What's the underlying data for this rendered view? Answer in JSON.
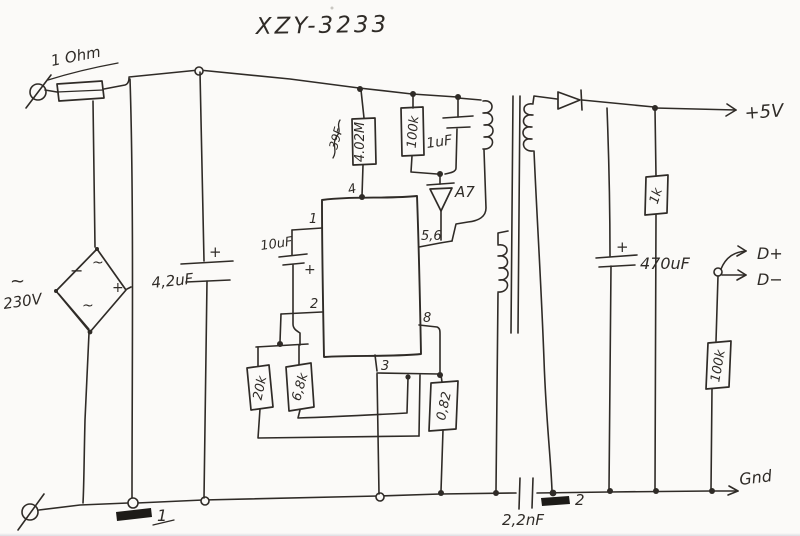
{
  "title": "XZY-3233",
  "colors": {
    "ink": "#2f2b27",
    "paper": "#fbfaf8"
  },
  "mains": {
    "fuse": "1 Ohm",
    "ac_wave": "~",
    "voltage": "230V"
  },
  "bridge": {
    "ac_top": "~",
    "minus": "−",
    "ac_bottom": "~",
    "plus": "+"
  },
  "primary_side": {
    "bulk_cap": "4,2uF",
    "bulk_cap_plus": "+",
    "startup_r": "4.02M",
    "startup_note": "39F",
    "r100k": "100k",
    "c1uf": "1uF",
    "zener": "A7",
    "c10uf": "10uF",
    "c10uf_plus": "+",
    "r20k": "20k",
    "r6k8": "6,8k",
    "rsense": "0,82"
  },
  "ic_pins": {
    "p1": "1",
    "p2": "2",
    "p3": "3",
    "p4": "4",
    "p8": "8",
    "p56": "5,6"
  },
  "bottom": {
    "ycap": "2,2nF",
    "mark1": "1",
    "mark2": "2",
    "gnd": "Gnd"
  },
  "secondary_side": {
    "vout": "+5V",
    "cout": "470uF",
    "cout_plus": "+",
    "r1k": "1k",
    "dplus": "D+",
    "dminus": "D−",
    "r100k": "100k"
  }
}
